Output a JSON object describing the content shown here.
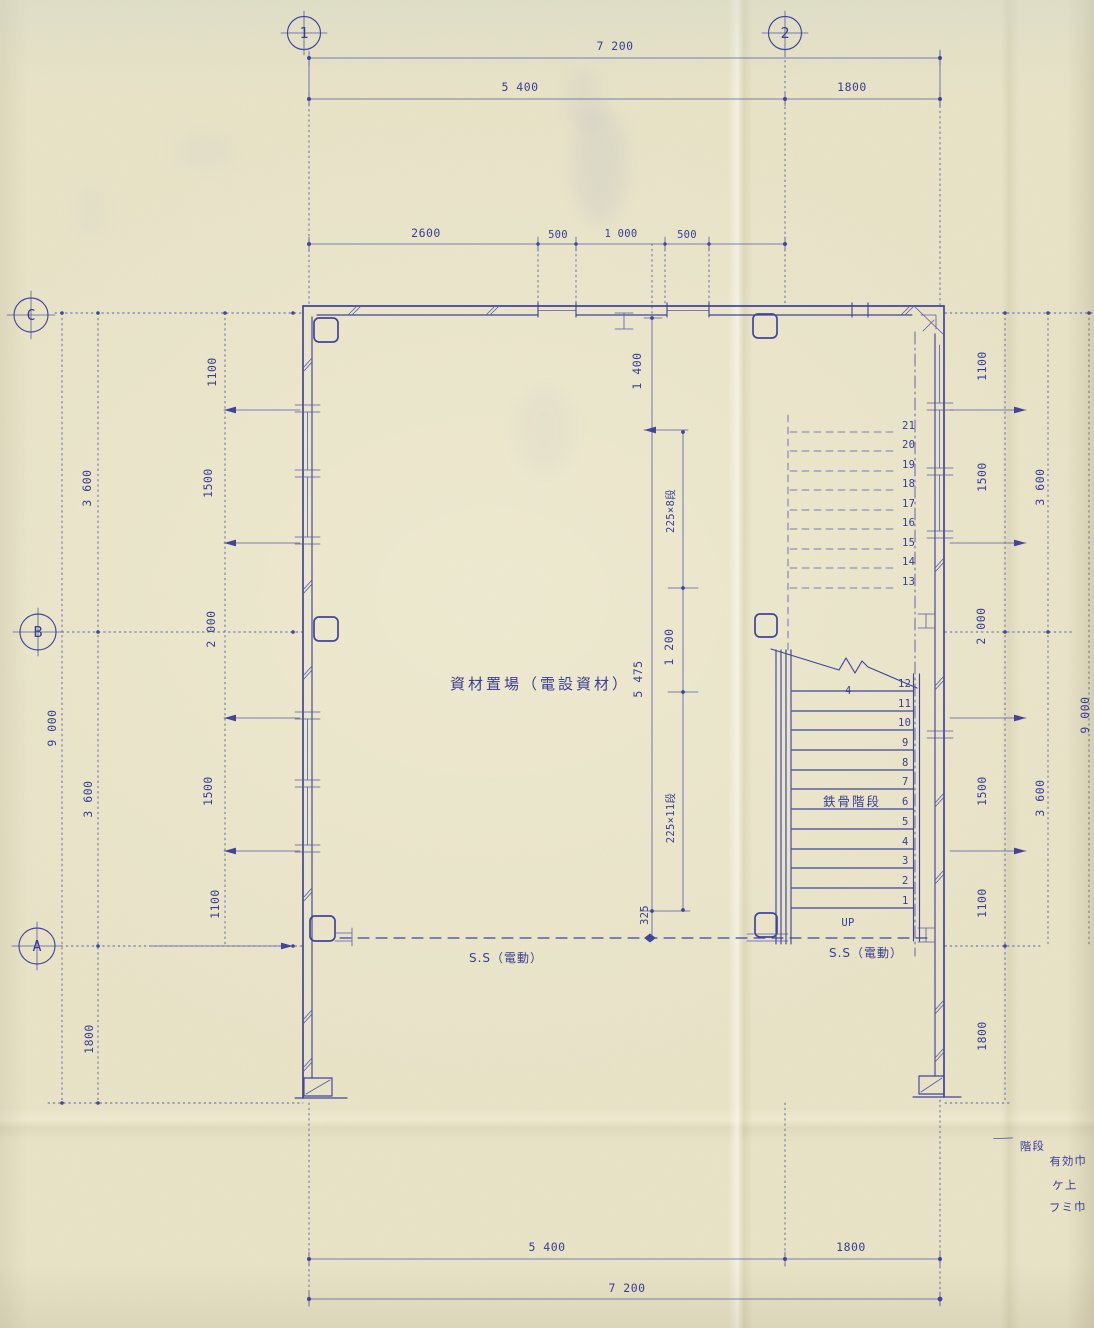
{
  "colors": {
    "ink": "#42449a",
    "paper": "#e9e4c8"
  },
  "grid": {
    "columns": [
      "1",
      "2"
    ],
    "rows": [
      "C",
      "B",
      "A"
    ]
  },
  "dimensions": {
    "top": {
      "overall": "7 200",
      "span_1_2": "5 400",
      "span_2_end": "1800"
    },
    "top_inner": [
      "2600",
      "500",
      "1 000",
      "500"
    ],
    "bottom": {
      "span_1_2": "5 400",
      "span_2_end": "1800",
      "overall": "7 200"
    },
    "left_inner": [
      "1100",
      "1500",
      "2 000",
      "1500",
      "1100"
    ],
    "left_outer": {
      "c_to_b": "3 600",
      "overall": "9 000",
      "b_to_a": "3 600",
      "below_a": "1800"
    },
    "right_inner": [
      "1100",
      "1500",
      "2 000",
      "1500",
      "1100",
      "1800"
    ],
    "right_outer": {
      "c_to_b": "3 600",
      "b_to_a": "3 600",
      "overall": "9 000"
    },
    "stair": {
      "top_offset": "1 400",
      "landing_total": "5 475",
      "landing_gap": "1 200",
      "upper_flight": "225×8段",
      "lower_flight": "225×11段",
      "bottom_offset": "325"
    }
  },
  "stair": {
    "upper_numbers": [
      "21",
      "20",
      "19",
      "18",
      "17",
      "16",
      "15",
      "14",
      "13"
    ],
    "lower_numbers": [
      "12",
      "11",
      "10",
      "9",
      "8",
      "7",
      "6",
      "5",
      "4",
      "3",
      "2",
      "1"
    ],
    "mid_mark": "4",
    "name_label": "鉄骨階段",
    "up_label": "UP"
  },
  "labels": {
    "room": "資材置場（電設資材）",
    "shutter_left": "S.S（電動）",
    "shutter_right": "S.S（電動）"
  },
  "notes": {
    "line1": "階段",
    "line2": "有効巾",
    "line3": "ケ上",
    "line4": "フミ巾"
  }
}
